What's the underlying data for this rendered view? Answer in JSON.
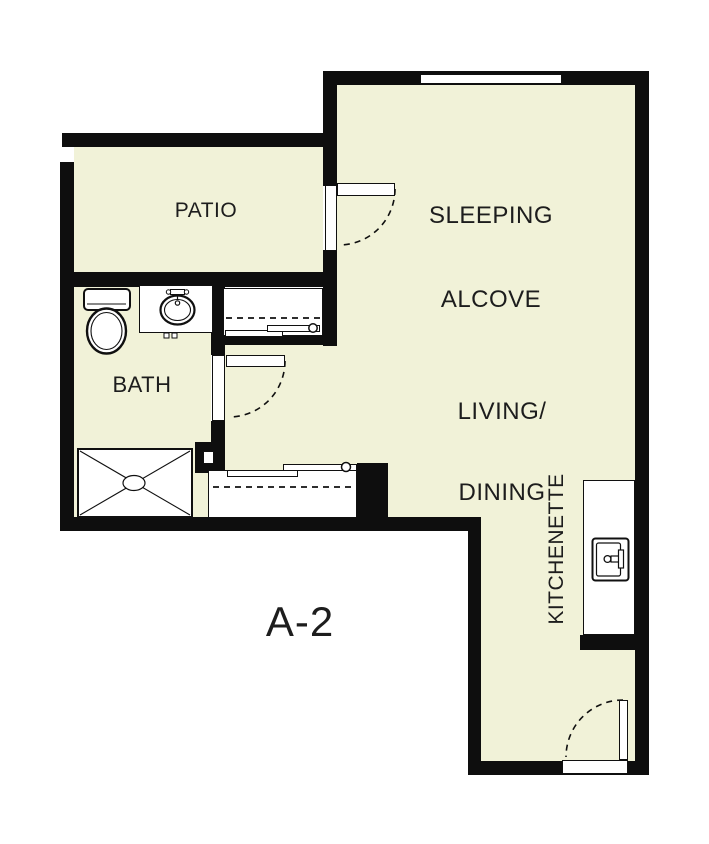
{
  "unit_label": "A-2",
  "rooms": {
    "patio": "PATIO",
    "sleeping": {
      "line1": "SLEEPING",
      "line2": "ALCOVE"
    },
    "living": {
      "line1": "LIVING/",
      "line2": "DINING"
    },
    "bath": "BATH",
    "kitchenette": "KITCHENETTE"
  },
  "fixture_icons": [
    "toilet-icon",
    "bathroom-sink-icon",
    "shower-icon",
    "kitchen-sink-icon",
    "sliding-closet-door-icon",
    "hinged-door-swing-icon",
    "window-icon"
  ],
  "colors": {
    "floor": "#f1f2d8",
    "wall": "#0e0e0e",
    "line": "#101010",
    "text": "#1d1d1d",
    "background": "#ffffff"
  }
}
